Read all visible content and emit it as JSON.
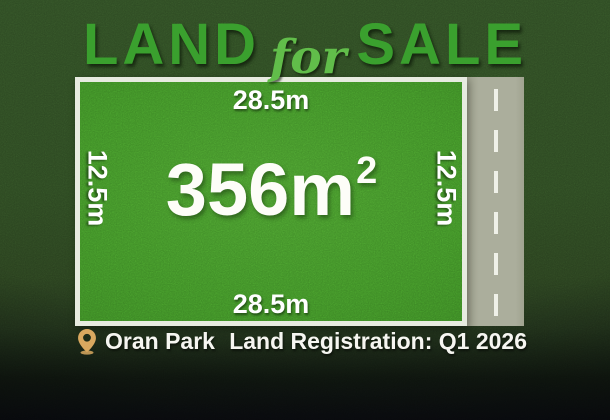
{
  "title": {
    "word_land": "LAND",
    "word_for": "for",
    "word_sale": "SALE",
    "accent_color": "#3aa02e",
    "script_color": "#61bd4a"
  },
  "plot": {
    "area_value": "356m",
    "area_superscript": "2",
    "frontage_top": "28.5m",
    "frontage_bottom": "28.5m",
    "depth_left": "12.5m",
    "depth_right": "12.5m",
    "grass_color": "#3e8b26",
    "border_color": "#e7ebe0"
  },
  "road": {
    "surface_color": "#abae9c",
    "lane_line_color": "#eff1e8",
    "lane_line_style": "dashed"
  },
  "footer": {
    "location_label": "Oran Park",
    "registration_label": "Land Registration: Q1 2026",
    "pin_color": "#d9a85f"
  },
  "background": {
    "grass_color": "#2c4721",
    "fade_color": "#0a0c10"
  }
}
